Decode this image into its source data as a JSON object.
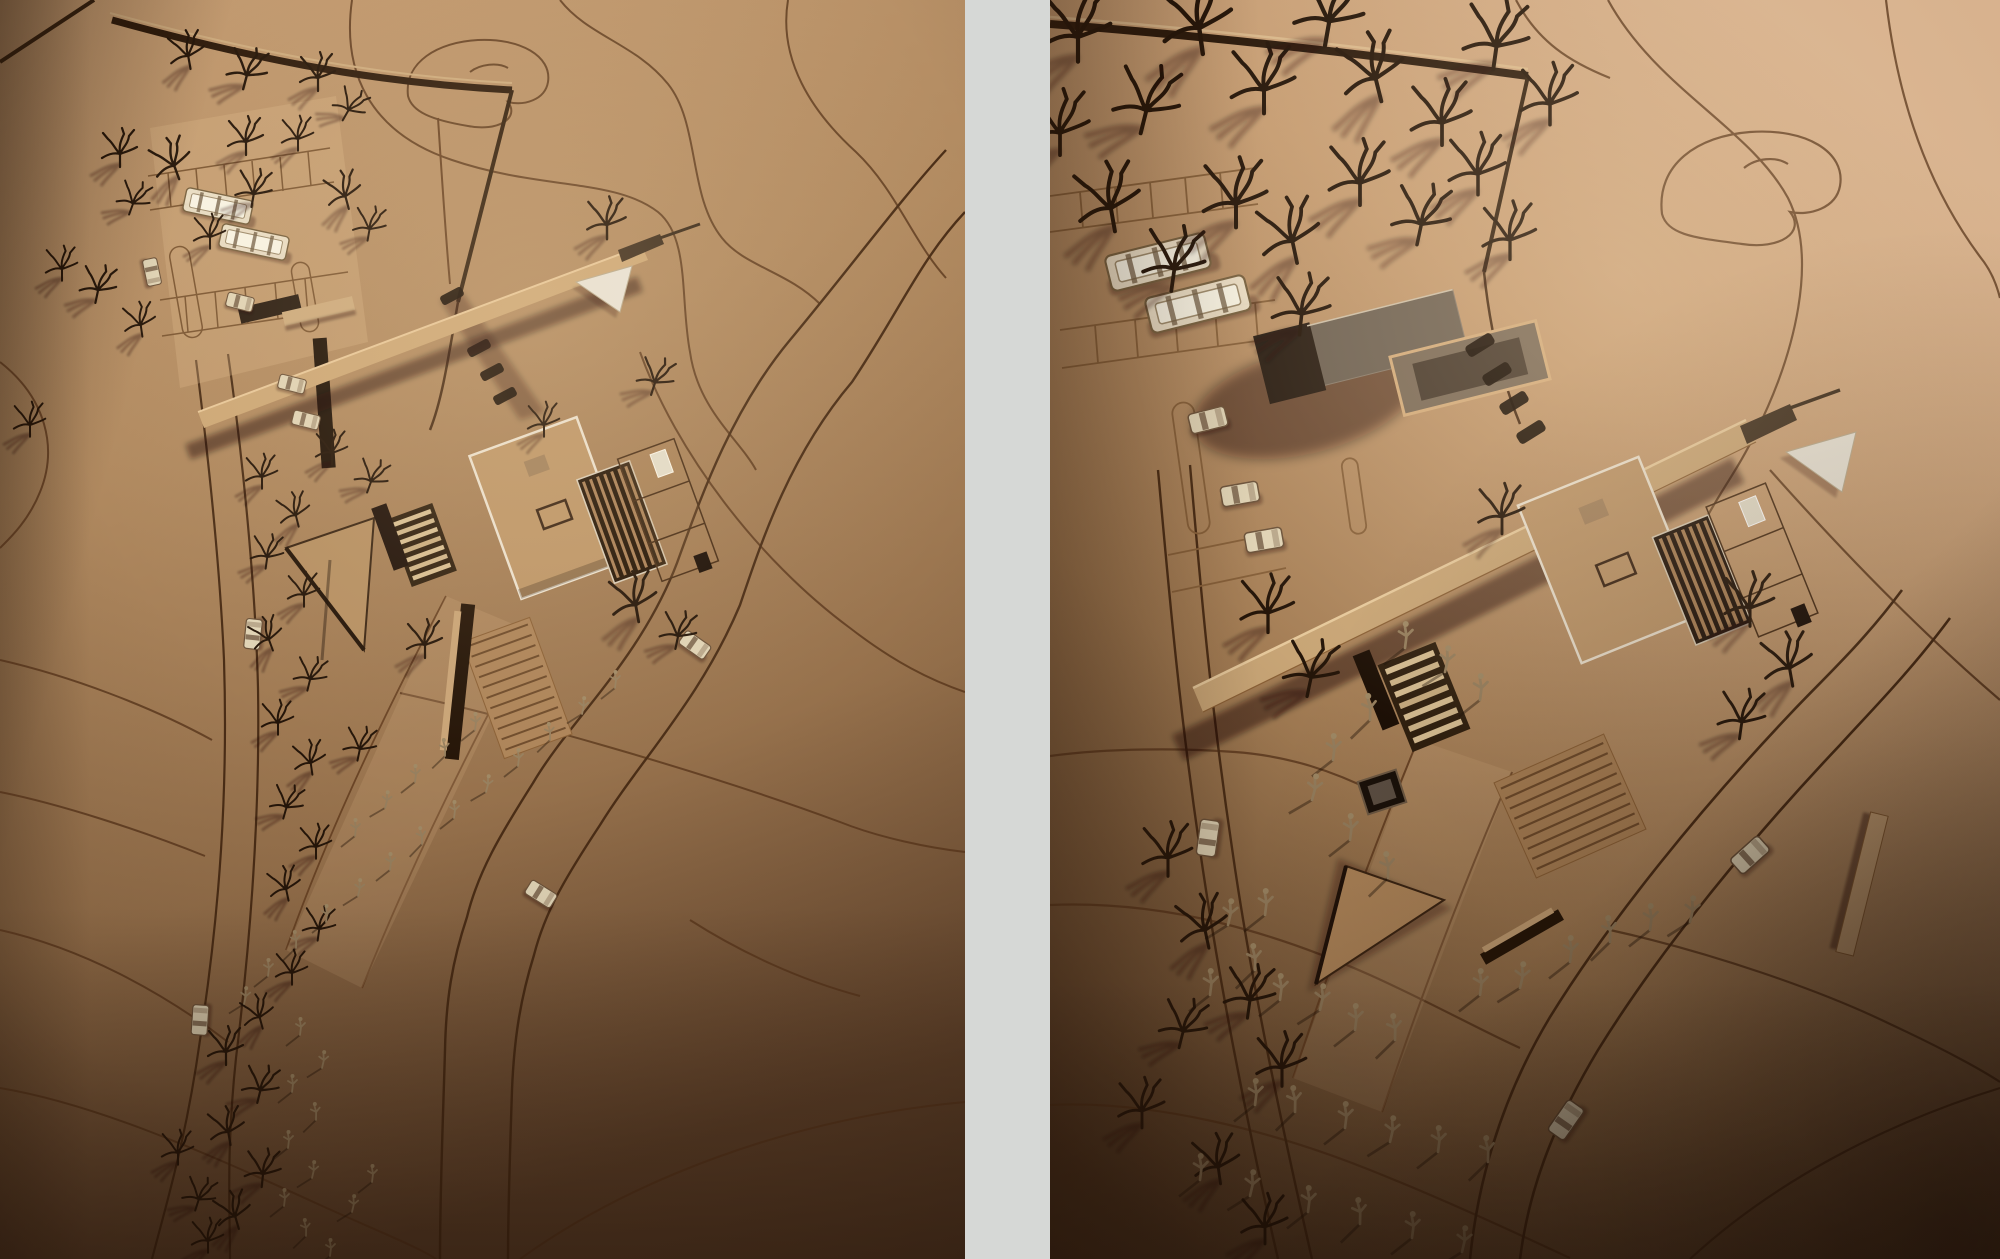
{
  "window": {
    "background": "#d6d8d6"
  },
  "divider": {
    "color": "#d6d8d6"
  },
  "palette": {
    "divider_gray": "#d6d8d6",
    "cardboard_light": "#cfa87e",
    "cardboard_mid": "#b08a60",
    "cardboard_dark": "#6b4b31",
    "engraved_line": "#5d3c20",
    "deep_shadow": "#2a1709",
    "acrylic": "#e6dcc4",
    "white_card": "#e9e5da"
  },
  "panels": {
    "left": {
      "label": "Cardboard architectural site model photograph, overview with building, parking, trees and paths"
    },
    "right": {
      "label": "Cardboard architectural site model photograph, closer view of the same building and site"
    }
  },
  "scenery": [
    {
      "layer": "left-trees",
      "symbol": "#tree",
      "items": [
        [
          190,
          66,
          1,
          -10
        ],
        [
          244,
          86,
          1.1,
          15
        ],
        [
          318,
          88,
          1,
          0
        ],
        [
          344,
          118,
          0.9,
          30
        ],
        [
          120,
          164,
          1,
          0
        ],
        [
          178,
          176,
          1.1,
          -20
        ],
        [
          252,
          204,
          1,
          10
        ],
        [
          298,
          148,
          0.9,
          0
        ],
        [
          130,
          212,
          0.9,
          20
        ],
        [
          62,
          278,
          0.9,
          0
        ],
        [
          96,
          300,
          1,
          12
        ],
        [
          142,
          334,
          0.9,
          -8
        ],
        [
          348,
          206,
          1,
          -15
        ],
        [
          368,
          238,
          0.9,
          10
        ],
        [
          246,
          152,
          1,
          0
        ],
        [
          210,
          246,
          0.9,
          0
        ],
        [
          607,
          236,
          1.1,
          0
        ],
        [
          652,
          392,
          1,
          18
        ],
        [
          544,
          434,
          0.9,
          0
        ],
        [
          638,
          618,
          1.3,
          -10
        ],
        [
          676,
          646,
          1,
          12
        ],
        [
          425,
          655,
          1,
          0
        ],
        [
          262,
          486,
          0.9,
          0
        ],
        [
          298,
          524,
          0.9,
          -14
        ],
        [
          266,
          566,
          0.9,
          8
        ],
        [
          304,
          604,
          0.9,
          0
        ],
        [
          272,
          648,
          0.9,
          -20
        ],
        [
          308,
          688,
          0.9,
          14
        ],
        [
          278,
          732,
          0.9,
          0
        ],
        [
          312,
          772,
          0.9,
          -8
        ],
        [
          284,
          816,
          0.9,
          16
        ],
        [
          316,
          856,
          0.9,
          0
        ],
        [
          288,
          898,
          0.9,
          -12
        ],
        [
          318,
          938,
          0.9,
          8
        ],
        [
          292,
          982,
          0.9,
          0
        ],
        [
          262,
          1026,
          0.9,
          -15
        ],
        [
          332,
          462,
          0.9,
          0
        ],
        [
          368,
          490,
          0.9,
          20
        ],
        [
          358,
          758,
          0.9,
          12
        ],
        [
          226,
          1062,
          1,
          0
        ],
        [
          258,
          1100,
          1,
          14
        ],
        [
          230,
          1142,
          1,
          -10
        ],
        [
          262,
          1184,
          1,
          6
        ],
        [
          238,
          1226,
          1,
          -16
        ],
        [
          208,
          1250,
          0.9,
          0
        ],
        [
          196,
          1208,
          0.9,
          18
        ],
        [
          178,
          1162,
          0.9,
          0
        ],
        [
          30,
          434,
          0.9,
          0
        ]
      ]
    },
    {
      "layer": "left-people",
      "symbol": "#person",
      "items": [
        [
          615,
          688,
          1,
          0
        ],
        [
          582,
          714,
          1,
          6
        ],
        [
          550,
          740,
          1,
          -6
        ],
        [
          518,
          766,
          1,
          0
        ],
        [
          486,
          792,
          1,
          8
        ],
        [
          454,
          818,
          1,
          0
        ],
        [
          422,
          844,
          1,
          -8
        ],
        [
          390,
          870,
          1,
          0
        ],
        [
          358,
          896,
          1,
          6
        ],
        [
          326,
          922,
          1,
          0
        ],
        [
          296,
          948,
          1,
          -6
        ],
        [
          268,
          976,
          1,
          0
        ],
        [
          244,
          1004,
          1,
          6
        ],
        [
          475,
          730,
          1,
          0
        ],
        [
          445,
          756,
          1,
          -6
        ],
        [
          415,
          782,
          1,
          0
        ],
        [
          385,
          808,
          1,
          8
        ],
        [
          355,
          836,
          1,
          0
        ],
        [
          300,
          1035,
          1,
          0
        ],
        [
          322,
          1068,
          1,
          6
        ],
        [
          292,
          1092,
          1,
          0
        ],
        [
          316,
          1120,
          1,
          -6
        ],
        [
          288,
          1148,
          1,
          0
        ],
        [
          312,
          1178,
          1,
          6
        ],
        [
          284,
          1206,
          1,
          0
        ],
        [
          306,
          1236,
          1,
          -6
        ],
        [
          330,
          1256,
          1,
          0
        ],
        [
          352,
          1212,
          1,
          6
        ],
        [
          372,
          1182,
          1,
          0
        ]
      ]
    },
    {
      "layer": "left-cars",
      "symbol": "#car",
      "items": [
        [
          695,
          645,
          1,
          35
        ],
        [
          541,
          894,
          1,
          32
        ],
        [
          253,
          634,
          1,
          -84
        ],
        [
          200,
          1020,
          1,
          -86
        ],
        [
          152,
          272,
          0.9,
          78
        ],
        [
          292,
          384,
          0.9,
          14
        ],
        [
          306,
          420,
          0.9,
          14
        ],
        [
          240,
          302,
          0.9,
          14
        ]
      ]
    },
    {
      "layer": "left-buses",
      "symbol": "#bus",
      "items": [
        [
          218,
          206,
          1,
          12
        ],
        [
          254,
          242,
          1,
          12
        ]
      ]
    },
    {
      "layer": "left-dashes",
      "symbol": "#dash",
      "items": [
        [
          452,
          296,
          1,
          62
        ],
        [
          466,
          322,
          1,
          62
        ],
        [
          479,
          348,
          1,
          62
        ],
        [
          492,
          372,
          1,
          62
        ],
        [
          505,
          396,
          1,
          62
        ]
      ]
    },
    {
      "layer": "right-trees",
      "symbol": "#tree",
      "items": [
        [
          28,
          56,
          1.9,
          0
        ],
        [
          92,
          128,
          1.8,
          14
        ],
        [
          152,
          48,
          2.0,
          -8
        ],
        [
          214,
          108,
          1.8,
          0
        ],
        [
          276,
          40,
          1.9,
          10
        ],
        [
          330,
          96,
          1.8,
          -14
        ],
        [
          392,
          140,
          1.7,
          0
        ],
        [
          444,
          64,
          1.8,
          8
        ],
        [
          500,
          120,
          1.6,
          0
        ],
        [
          64,
          226,
          1.8,
          -10
        ],
        [
          122,
          286,
          1.7,
          8
        ],
        [
          186,
          222,
          1.8,
          0
        ],
        [
          246,
          258,
          1.7,
          -12
        ],
        [
          310,
          200,
          1.7,
          0
        ],
        [
          368,
          240,
          1.6,
          12
        ],
        [
          428,
          190,
          1.6,
          0
        ],
        [
          250,
          330,
          1.6,
          6
        ],
        [
          460,
          255,
          1.5,
          0
        ],
        [
          10,
          150,
          1.7,
          0
        ],
        [
          218,
          628,
          1.5,
          0
        ],
        [
          258,
          692,
          1.5,
          12
        ],
        [
          452,
          530,
          1.3,
          0
        ],
        [
          700,
          622,
          1.4,
          0
        ],
        [
          742,
          682,
          1.4,
          -10
        ],
        [
          690,
          735,
          1.3,
          8
        ],
        [
          118,
          872,
          1.4,
          0
        ],
        [
          158,
          944,
          1.4,
          -12
        ],
        [
          198,
          1014,
          1.4,
          8
        ],
        [
          232,
          1082,
          1.4,
          0
        ],
        [
          130,
          1044,
          1.3,
          14
        ],
        [
          92,
          1124,
          1.3,
          0
        ],
        [
          170,
          1180,
          1.3,
          -8
        ],
        [
          215,
          1240,
          1.3,
          0
        ]
      ]
    },
    {
      "layer": "right-people",
      "symbol": "#person",
      "items": [
        [
          355,
          648,
          1.5,
          0
        ],
        [
          395,
          672,
          1.5,
          6
        ],
        [
          430,
          700,
          1.5,
          0
        ],
        [
          320,
          720,
          1.5,
          -6
        ],
        [
          283,
          760,
          1.5,
          0
        ],
        [
          262,
          800,
          1.5,
          8
        ],
        [
          300,
          840,
          1.5,
          0
        ],
        [
          338,
          878,
          1.5,
          -6
        ],
        [
          215,
          915,
          1.5,
          0
        ],
        [
          178,
          925,
          1.5,
          6
        ],
        [
          160,
          995,
          1.5,
          0
        ],
        [
          205,
          970,
          1.5,
          -6
        ],
        [
          230,
          1000,
          1.5,
          0
        ],
        [
          270,
          1010,
          1.5,
          6
        ],
        [
          305,
          1030,
          1.5,
          0
        ],
        [
          345,
          1040,
          1.5,
          -6
        ],
        [
          430,
          995,
          1.5,
          0
        ],
        [
          470,
          988,
          1.5,
          6
        ],
        [
          520,
          962,
          1.5,
          0
        ],
        [
          560,
          942,
          1.5,
          -6
        ],
        [
          600,
          930,
          1.5,
          0
        ],
        [
          640,
          922,
          1.5,
          6
        ],
        [
          205,
          1105,
          1.5,
          0
        ],
        [
          245,
          1112,
          1.5,
          -6
        ],
        [
          295,
          1128,
          1.5,
          0
        ],
        [
          340,
          1142,
          1.5,
          6
        ],
        [
          388,
          1152,
          1.5,
          0
        ],
        [
          438,
          1162,
          1.5,
          -6
        ],
        [
          150,
          1180,
          1.5,
          0
        ],
        [
          200,
          1196,
          1.5,
          6
        ],
        [
          258,
          1212,
          1.5,
          0
        ],
        [
          310,
          1224,
          1.5,
          -6
        ],
        [
          362,
          1238,
          1.5,
          0
        ],
        [
          412,
          1252,
          1.5,
          6
        ]
      ]
    },
    {
      "layer": "right-cars",
      "symbol": "#car",
      "items": [
        [
          700,
          855,
          1.25,
          -42
        ],
        [
          516,
          1120,
          1.25,
          -55
        ],
        [
          158,
          838,
          1.2,
          -82
        ],
        [
          158,
          420,
          1.25,
          -14
        ],
        [
          190,
          494,
          1.25,
          -10
        ],
        [
          214,
          540,
          1.25,
          -10
        ]
      ]
    },
    {
      "layer": "right-buses",
      "symbol": "#bus",
      "items": [
        [
          108,
          262,
          1.5,
          -14
        ],
        [
          148,
          304,
          1.5,
          -14
        ]
      ]
    },
    {
      "layer": "right-dashes",
      "symbol": "#dash",
      "items": [
        [
          430,
          345,
          1.25,
          58
        ],
        [
          447,
          374,
          1.25,
          58
        ],
        [
          464,
          403,
          1.25,
          58
        ],
        [
          481,
          432,
          1.25,
          58
        ]
      ]
    }
  ]
}
